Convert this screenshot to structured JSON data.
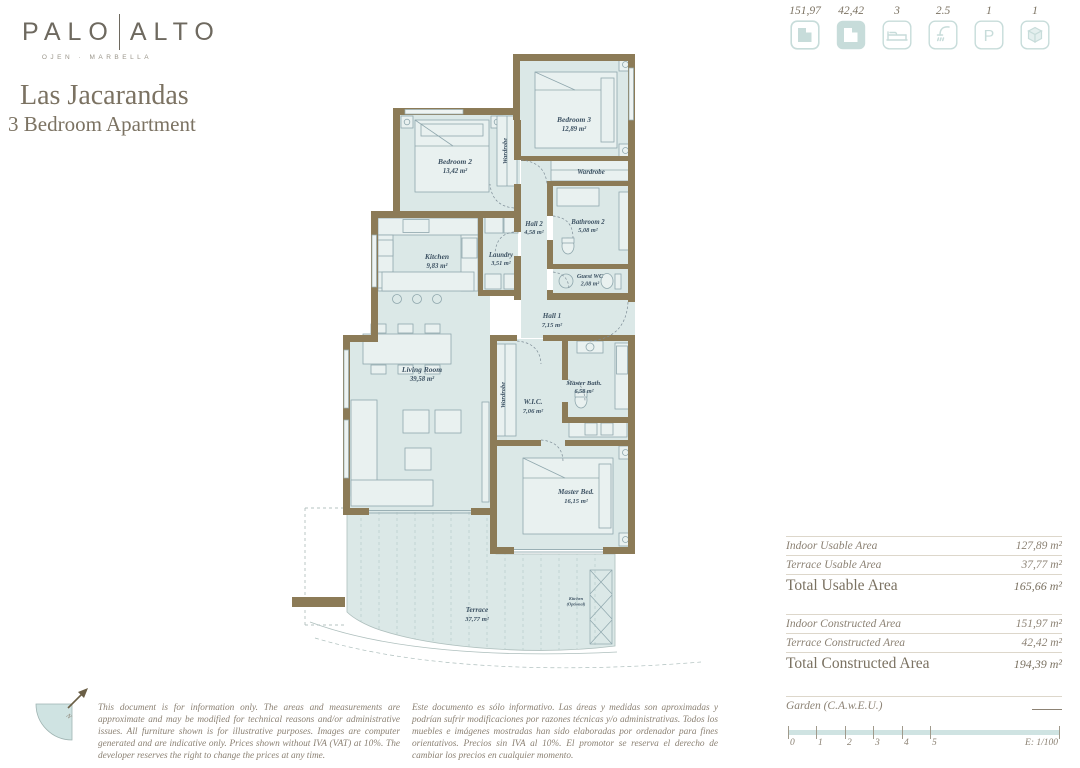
{
  "brand": {
    "name_left": "PALO",
    "name_right": "ALTO",
    "tagline": "OJEN · MARBELLA"
  },
  "title": "Las Jacarandas",
  "subtitle": "3 Bedroom Apartment",
  "specs": [
    {
      "value": "151,97",
      "icon": "indoor-constructed-plan-icon"
    },
    {
      "value": "42,42",
      "icon": "terrace-constructed-plan-icon"
    },
    {
      "value": "3",
      "icon": "bedrooms-icon"
    },
    {
      "value": "2.5",
      "icon": "bathrooms-icon"
    },
    {
      "value": "1",
      "icon": "parking-icon"
    },
    {
      "value": "1",
      "icon": "storage-icon"
    }
  ],
  "plan": {
    "rooms": [
      {
        "name": "Bedroom 2",
        "area": "13,42 m²"
      },
      {
        "name": "Bedroom 3",
        "area": "12,89 m²"
      },
      {
        "name": "Wardrobe",
        "area": ""
      },
      {
        "name": "Wardrobe",
        "area": ""
      },
      {
        "name": "Hall 2",
        "area": "4,58 m²"
      },
      {
        "name": "Bathroom 2",
        "area": "5,08 m²"
      },
      {
        "name": "Kitchen",
        "area": "9,83 m²"
      },
      {
        "name": "Laundry",
        "area": "3,51 m²"
      },
      {
        "name": "Guest WC",
        "area": "2,08 m²"
      },
      {
        "name": "Hall 1",
        "area": "7,15 m²"
      },
      {
        "name": "Living Room",
        "area": "39,58 m²"
      },
      {
        "name": "Wardrobe",
        "area": ""
      },
      {
        "name": "W.I.C.",
        "area": "7,06 m²"
      },
      {
        "name": "Master Bath.",
        "area": "6,58 m²"
      },
      {
        "name": "Master Bed.",
        "area": "16,15 m²"
      },
      {
        "name": "Terrace",
        "area": "37,77 m²"
      },
      {
        "name": "Kitchen",
        "area": "(Optional)"
      }
    ],
    "compass_label": "N"
  },
  "areas": {
    "usable": {
      "rows": [
        {
          "label": "Indoor Usable Area",
          "value": "127,89 m²"
        },
        {
          "label": "Terrace Usable Area",
          "value": "37,77 m²"
        }
      ],
      "total": {
        "label": "Total Usable Area",
        "value": "165,66 m²"
      }
    },
    "constructed": {
      "rows": [
        {
          "label": "Indoor Constructed Area",
          "value": "151,97 m²"
        },
        {
          "label": "Terrace Constructed Area",
          "value": "42,42 m²"
        }
      ],
      "total": {
        "label": "Total Constructed Area",
        "value": "194,39 m²"
      }
    },
    "garden": {
      "label": "Garden (C.A.w.E.U.)",
      "value": ""
    }
  },
  "scale": {
    "ticks": [
      "0",
      "1",
      "2",
      "3",
      "4",
      "5"
    ],
    "label": "E: 1/100"
  },
  "disclaimer_en": "This document is for information only. The areas and measurements are approximate and may be modified for technical reasons and/or administrative issues. All furniture shown is for illustrative purposes. Images are computer generated and are indicative only. Prices shown without IVA (VAT) at 10%. The developer reserves the right to change the prices at any time.",
  "disclaimer_es": "Este documento es sólo informativo. Las áreas y medidas son aproximadas y podrían sufrir modificaciones por razones técnicas y/o administrativas. Todos los muebles e imágenes mostradas han sido elaboradas por ordenador para fines orientativos. Precios sin IVA al 10%. El promotor se reserva el derecho de cambiar los precios en cualquier momento.",
  "colors": {
    "wall": "#8c7b57",
    "floor": "#dbe8e7",
    "accent": "#c7dcda",
    "room_text": "#3d5263",
    "muted_text": "#8b8173"
  }
}
